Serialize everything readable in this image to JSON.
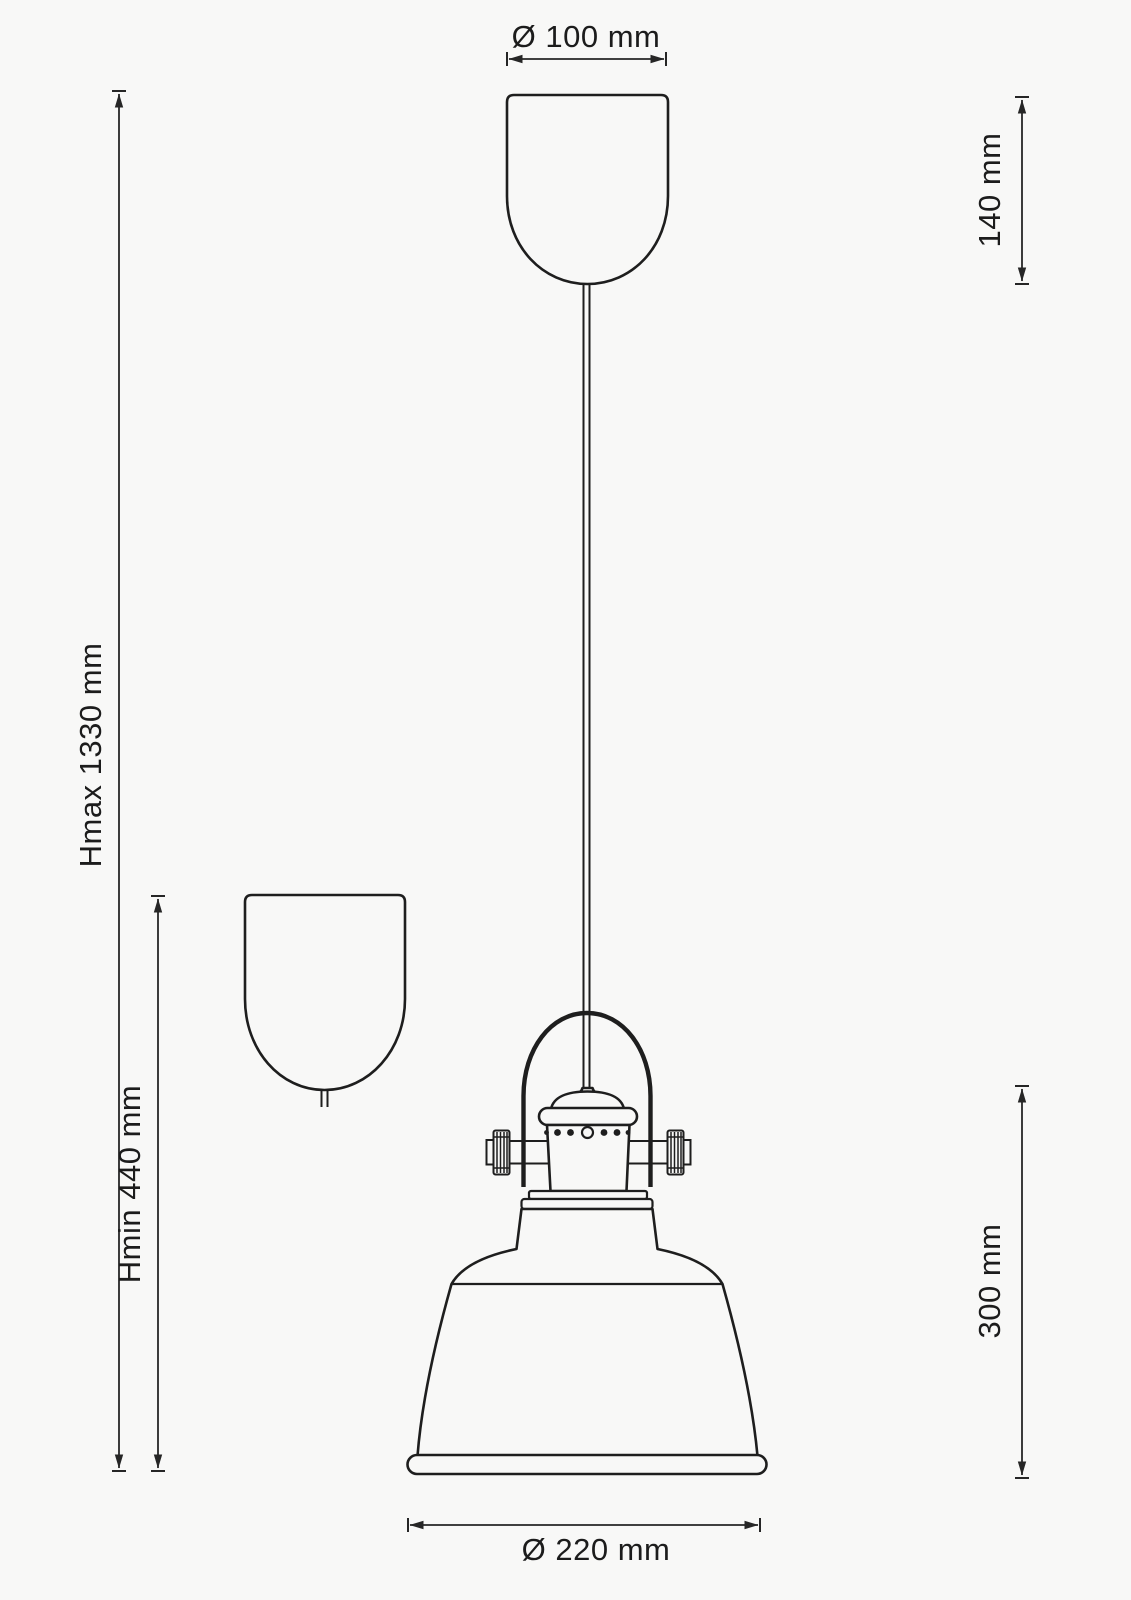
{
  "drawing": {
    "labels": {
      "canopy_diameter": "Ø 100 mm",
      "canopy_height": "140 mm",
      "max_height": "Hmax 1330 mm",
      "min_height": "Hmin 440 mm",
      "shade_height": "300 mm",
      "shade_diameter": "Ø 220 mm"
    },
    "colors": {
      "line": "#1e1e1e",
      "dimension": "#262626",
      "background": "#f8f8f7"
    }
  }
}
